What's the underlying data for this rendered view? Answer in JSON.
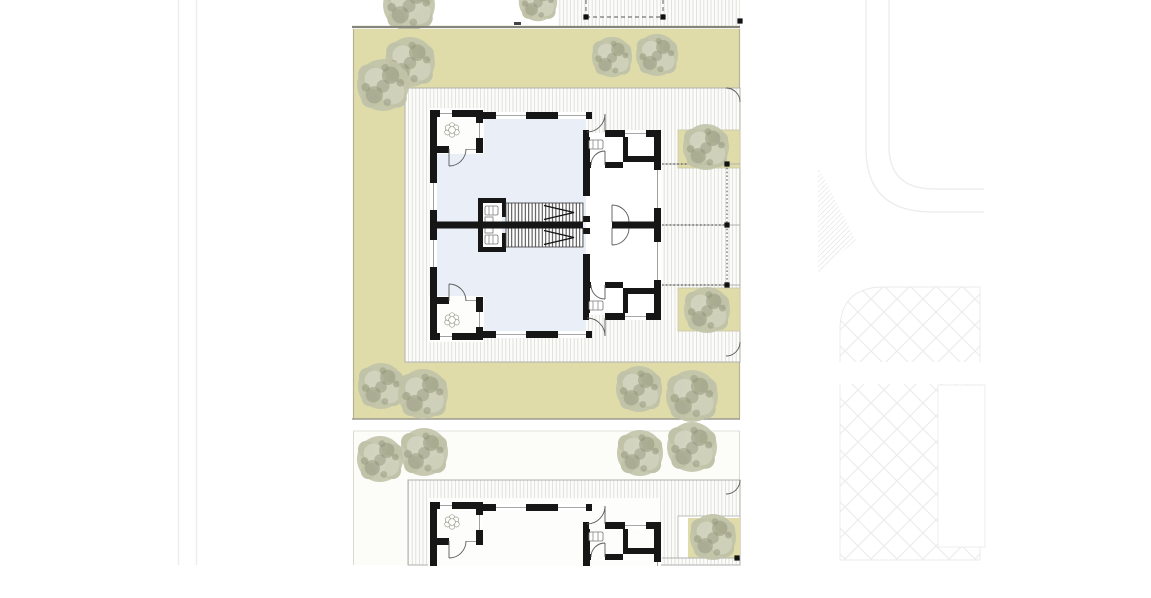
{
  "meta": {
    "drawing_type": "architectural site plan",
    "content": "ground floor plan of mirrored semi-detached house on landscaped lot, identical lot partially visible below, road and paving hatch at right",
    "visible_text": ""
  },
  "colors": {
    "site_beige": "#dfdcaa",
    "site_edge": "#b6b394",
    "wall": "#161616",
    "interior_blue": "#e9eef7",
    "deck_bg": "#fcfcfb",
    "deck_line": "#d9d9d4",
    "deck_border": "#b0b0ac",
    "boundary": "#85857a",
    "faint": "#ededee",
    "tree_base": "#c1c3a9",
    "tree_dark": "#8f9377",
    "tree_light": "#d7d8c5",
    "arc": "#5a5a5a",
    "post": "#111111"
  },
  "trees": {
    "site": [
      {
        "x": 410,
        "y": 62,
        "r": 26
      },
      {
        "x": 383,
        "y": 85,
        "r": 27
      },
      {
        "x": 612,
        "y": 57,
        "r": 21
      },
      {
        "x": 657,
        "y": 55,
        "r": 22
      },
      {
        "x": 706,
        "y": 147,
        "r": 24
      },
      {
        "x": 707,
        "y": 310,
        "r": 24
      },
      {
        "x": 381,
        "y": 386,
        "r": 24
      },
      {
        "x": 423,
        "y": 394,
        "r": 26
      },
      {
        "x": 639,
        "y": 389,
        "r": 24
      },
      {
        "x": 692,
        "y": 396,
        "r": 27
      }
    ],
    "top_strip": [
      {
        "x": 409,
        "y": 5,
        "r": 27
      },
      {
        "x": 538,
        "y": 2,
        "r": 20
      }
    ],
    "bottom_lot": [
      {
        "x": 380,
        "y": 459,
        "r": 24
      },
      {
        "x": 424,
        "y": 452,
        "r": 25
      },
      {
        "x": 640,
        "y": 453,
        "r": 24
      },
      {
        "x": 692,
        "y": 447,
        "r": 26
      },
      {
        "x": 713,
        "y": 537,
        "r": 24
      }
    ]
  },
  "plants": [
    {
      "x": 452,
      "y": 130,
      "r": 14
    },
    {
      "x": 452,
      "y": 320,
      "r": 14
    },
    {
      "x": 452,
      "y": 522,
      "r": 14
    }
  ],
  "markers": {
    "posts": [
      {
        "x": 727,
        "y": 164
      },
      {
        "x": 727,
        "y": 225
      },
      {
        "x": 727,
        "y": 285
      },
      {
        "x": 586,
        "y": 17
      },
      {
        "x": 663,
        "y": 17
      },
      {
        "x": 740,
        "y": 21
      },
      {
        "x": 737,
        "y": 558
      }
    ]
  }
}
